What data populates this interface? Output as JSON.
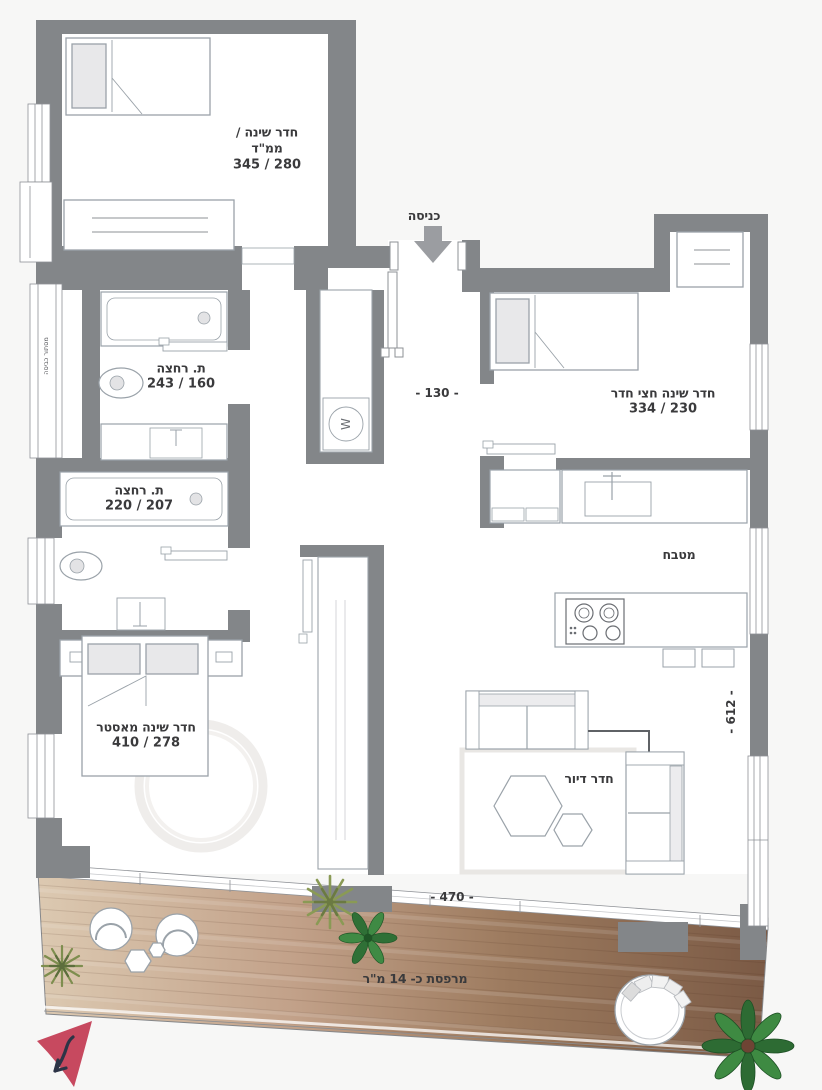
{
  "plan": {
    "entrance_label": "כניסה",
    "laundry_label": "מסתור כביסה",
    "washer_symbol": "W",
    "rooms": {
      "bedroom_mamad": {
        "line1": "חדר שינה /",
        "line2": "ממ\"ד",
        "dims": "280 / 345"
      },
      "bedroom_half": {
        "name": "חדר שינה חצי חדר",
        "dims": "230 / 334"
      },
      "bath_top": {
        "name": "ת. רחצה",
        "dims": "160 / 243"
      },
      "bath_bottom": {
        "name": "ת. רחצה",
        "dims": "207 / 220"
      },
      "master": {
        "name": "חדר שינה מאסטר",
        "dims": "278 / 410"
      },
      "kitchen": {
        "name": "מטבח"
      },
      "living": {
        "name": "חדר דיור"
      },
      "balcony": {
        "name": "מרפסת כ- 14 מ\"ר"
      }
    },
    "dimensions": {
      "entry": "- 130 -",
      "right_side": "- 612 -",
      "balcony": "- 470 -"
    },
    "colors": {
      "wall": "#838689",
      "background": "#f7f7f6",
      "north_arrow": "#c7495f",
      "wood_light": "#dcc9b1",
      "wood_dark": "#7b5a45"
    }
  }
}
